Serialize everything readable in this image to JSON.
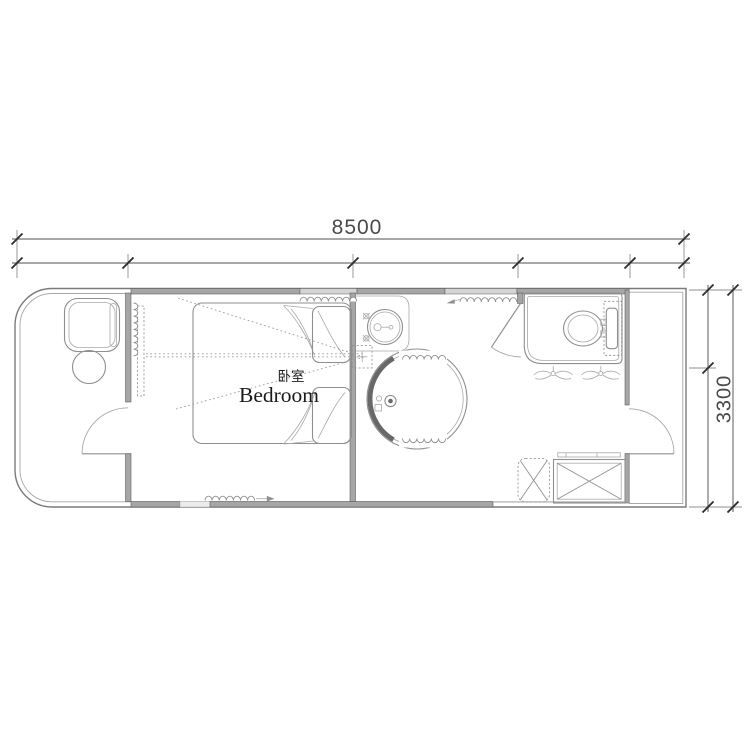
{
  "drawing": {
    "kind": "floor-plan",
    "room": {
      "label_zh": "卧室",
      "label_en": "Bedroom"
    },
    "dimensions": {
      "overall_width": "8500",
      "overall_depth": "3300"
    }
  },
  "colors": {
    "background": "#ffffff",
    "wall_fill": "#a6a6a6",
    "window_fill": "#d4d4d4",
    "opening_fill": "#ececec",
    "wall_edge": "#606060",
    "outline": "#7a7a7a",
    "line_mid": "#8f8f8f",
    "line_light": "#a8a8a8",
    "dim_line": "#8a8a8a",
    "tick": "#2e2e2e",
    "dim_text": "#4a4a4a",
    "room_text": "#1c1c1c",
    "dotted": "#979797",
    "shower_screen": "#686868"
  }
}
